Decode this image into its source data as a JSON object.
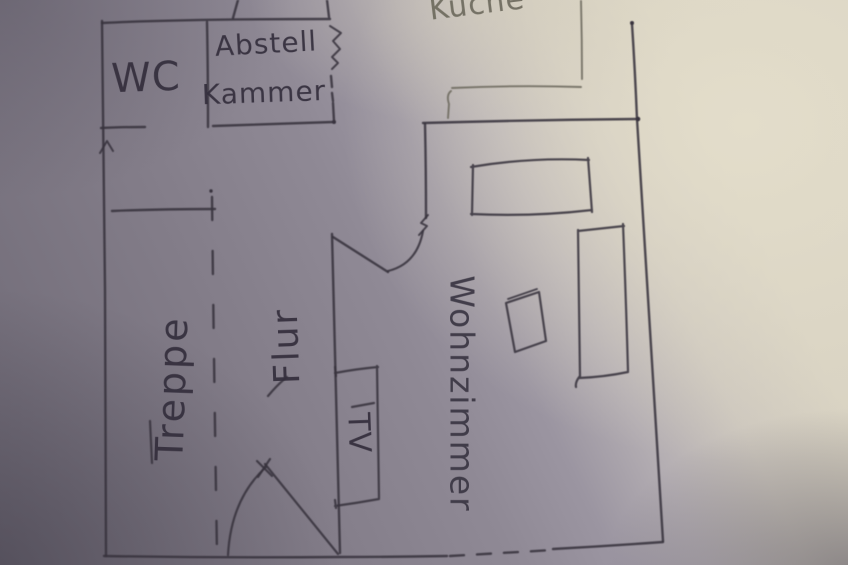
{
  "rooms": [
    {
      "name": "wc",
      "label": "WC"
    },
    {
      "name": "abstellkammer",
      "label_line1": "Abstell",
      "label_line2": "Kammer"
    },
    {
      "name": "kueche",
      "label": "Küche"
    },
    {
      "name": "treppe",
      "label": "Treppe"
    },
    {
      "name": "flur",
      "label": "Flur"
    },
    {
      "name": "wohnzimmer",
      "label": "Wohnzimmer"
    }
  ],
  "furniture": [
    {
      "name": "tv",
      "label": "TV"
    }
  ],
  "colors": {
    "ink": "#38333e",
    "pencil_light": "#6f6b60",
    "paper_bright": "#d9d3c3",
    "paper_shadow": "#837d89"
  }
}
